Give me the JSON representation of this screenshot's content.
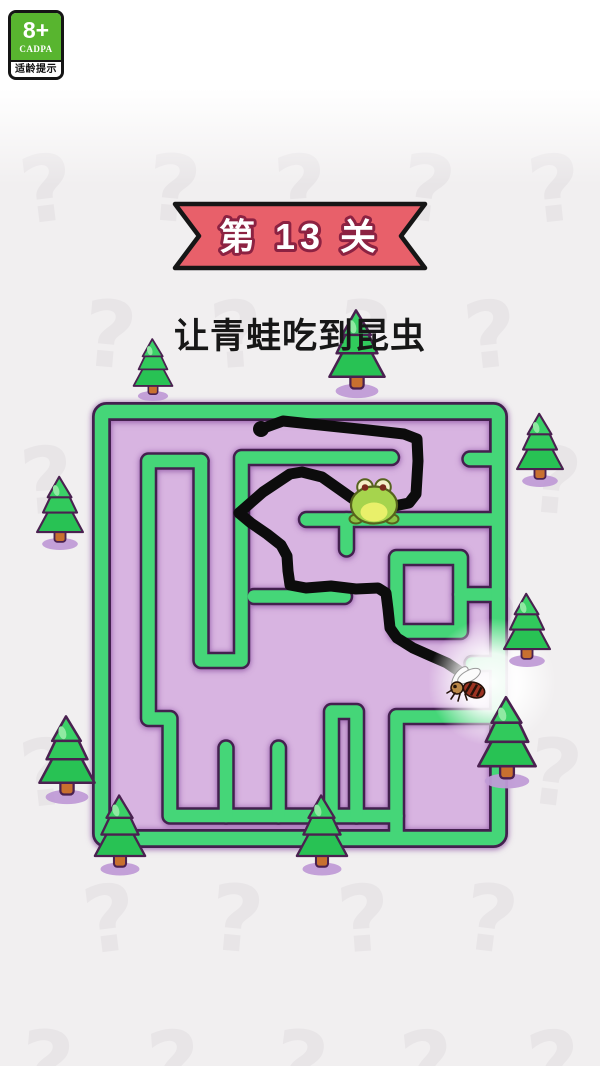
{
  "page": {
    "width": 600,
    "height": 1066,
    "bg": "#f1eff0"
  },
  "age_badge": {
    "rating": "8+",
    "org": "CADPA",
    "tip": "适龄提示",
    "green": "#58b52f"
  },
  "level_banner": {
    "label": "第 13 关",
    "fill": "#e8606a",
    "stroke": "#161616",
    "text_fill": "#ffffff",
    "text_outline": "#8c2242",
    "shape_points": "175,204 425,204 401,236 425,268 175,268 199,236"
  },
  "instruction": {
    "text": "让青蛙吃到昆虫"
  },
  "maze": {
    "floor": "#d8b4e1",
    "wall_green": "#45d678",
    "wall_outline": "#43204e",
    "outer": {
      "x": 101.5,
      "y": 411.5,
      "w": 397,
      "h": 427,
      "rx": 5,
      "green_w": 13.5,
      "dark_w": 19
    },
    "wall_green_w": 12.5,
    "wall_dark_w": 17.5,
    "walls": [
      "M201,461 L148.5,461 L148.5,718.5 L170,718.5 L170,816 L396.5,816 L396.5,716.5 L498,716.5",
      "M201,461 L201,660.5 L241.5,660.5 L241.5,457.5 L391.5,457.5",
      "M396.5,816 L396.5,836",
      "M226,816 L226,748",
      "M278.5,816 L278.5,748",
      "M331.5,816 L331.5,711.5 L356.5,711.5 L356.5,816",
      "M254,596.5 L344.5,596.5",
      "M498,459 L470,459",
      "M306.5,519.5 L498,519.5",
      "M346.5,519.5 L346.5,549",
      "M396.5,557.5 L460.5,557.5 L460.5,631.5 L396.5,631.5 Z",
      "M460.5,594.5 L498,594.5",
      "M498,663.5 L472,663.5"
    ]
  },
  "path_line": {
    "color": "#0c0c0c",
    "width": 11,
    "start_knob": [
      261,
      429
    ],
    "points": [
      [
        261,
        429
      ],
      [
        283,
        421
      ],
      [
        320,
        425
      ],
      [
        368,
        430
      ],
      [
        404,
        434
      ],
      [
        417,
        439
      ],
      [
        418,
        461
      ],
      [
        416,
        494
      ],
      [
        409,
        503
      ],
      [
        394,
        506
      ],
      [
        372,
        503
      ],
      [
        356,
        501
      ],
      [
        339,
        489
      ],
      [
        322,
        477
      ],
      [
        302,
        472
      ],
      [
        290,
        474
      ],
      [
        263,
        492
      ],
      [
        239,
        513
      ],
      [
        251,
        523
      ],
      [
        267,
        534
      ],
      [
        281,
        545
      ],
      [
        287,
        556
      ],
      [
        288,
        571
      ],
      [
        290,
        585
      ],
      [
        306,
        588
      ],
      [
        331,
        586
      ],
      [
        356,
        589
      ],
      [
        378,
        588
      ],
      [
        386,
        593
      ],
      [
        388,
        609
      ],
      [
        390,
        628
      ],
      [
        397,
        638
      ],
      [
        413,
        648
      ],
      [
        431,
        656
      ],
      [
        447,
        663
      ],
      [
        459,
        671
      ]
    ]
  },
  "frog": {
    "x": 374,
    "y": 505,
    "body": "#a6d44d",
    "belly": "#e9f06a",
    "outline": "#56621d",
    "eye": "#f4efc9",
    "pupil": "#7c2a1e",
    "foot": "#8cc445"
  },
  "fly": {
    "x": 468,
    "y": 688,
    "wing": "#fbfbfb",
    "wing_edge": "#9a9a9a",
    "body": "#9c3322",
    "head": "#bb8848",
    "dark": "#241209"
  },
  "glow": {
    "x": 492,
    "y": 682,
    "r": 64
  },
  "decor": {
    "tree_colors": {
      "outline": "#4a2150",
      "tier_bottom": "#28c254",
      "tier_mid": "#31ca5c",
      "apex": "#3bd167",
      "highlight": "#8fe9a2",
      "trunk": "#c8702f",
      "shadow": "#c09bd6"
    },
    "trees": [
      {
        "x": 153,
        "y": 396,
        "s": 0.72
      },
      {
        "x": 357,
        "y": 391,
        "s": 1.02
      },
      {
        "x": 540,
        "y": 481,
        "s": 0.85
      },
      {
        "x": 60,
        "y": 544,
        "s": 0.85
      },
      {
        "x": 527,
        "y": 661,
        "s": 0.85
      },
      {
        "x": 507,
        "y": 781,
        "s": 1.06
      },
      {
        "x": 67,
        "y": 797,
        "s": 1.02
      },
      {
        "x": 120,
        "y": 869,
        "s": 0.93
      },
      {
        "x": 322,
        "y": 869,
        "s": 0.93
      }
    ],
    "qmarks": {
      "color": "#e8e5e7",
      "rows_y": [
        144,
        290,
        436,
        582,
        728,
        874,
        1020
      ],
      "cols_even": [
        50,
        177,
        304,
        431,
        558
      ],
      "cols_odd": [
        113,
        240,
        367,
        494
      ],
      "tilts": [
        -7,
        5,
        -4,
        7,
        -6
      ],
      "glyph": "?"
    }
  }
}
